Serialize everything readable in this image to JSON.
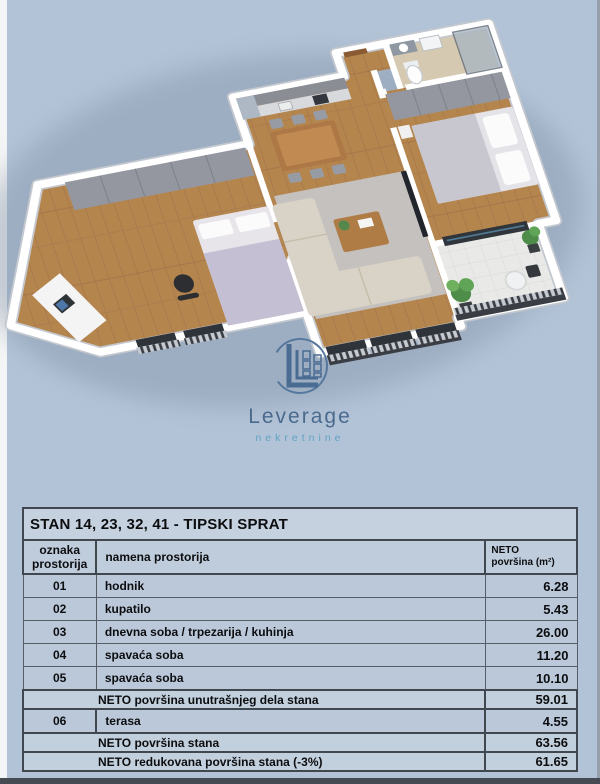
{
  "page": {
    "background": "#b3c3d7"
  },
  "branding": {
    "logo_text": "Leverage",
    "logo_subtext": "nekretnine",
    "logo_color": "#4a6a8e",
    "logo_subtext_color": "#5fa3c4",
    "mark_color": "#4a6c92"
  },
  "floorplan_colors": {
    "walls": "#ffffff",
    "wood_floor": "#b5854e",
    "bathroom_floor": "#d6c9b2",
    "terrace_floor": "#e9eae7",
    "rug": "#c6c9ce",
    "sofa": "#d9d2c6",
    "wardrobe": "#94979f",
    "plants": "#55884d",
    "railing": "#3a3e44",
    "shadow": "#7e8ea3"
  },
  "table": {
    "title": "STAN  14, 23, 32, 41 - TIPSKI SPRAT",
    "col_headers": {
      "col1_line1": "oznaka",
      "col1_line2": "prostorija",
      "col2": "namena prostorija",
      "col3_line1": "NETO",
      "col3_line2": "površina (m²)"
    },
    "rows": [
      {
        "code": "01",
        "name": "hodnik",
        "area": "6.28"
      },
      {
        "code": "02",
        "name": "kupatilo",
        "area": "5.43"
      },
      {
        "code": "03",
        "name": "dnevna soba / trpezarija / kuhinja",
        "area": "26.00"
      },
      {
        "code": "04",
        "name": "spavaća soba",
        "area": "11.20"
      },
      {
        "code": "05",
        "name": "spavaća soba",
        "area": "10.10"
      }
    ],
    "summary_inner": {
      "label": "NETO površina unutrašnjeg dela stana",
      "area": "59.01"
    },
    "terrace_row": {
      "code": "06",
      "name": "terasa",
      "area": "4.55"
    },
    "summary_total": {
      "label": "NETO površina stana",
      "area": "63.56"
    },
    "summary_reduced": {
      "label": "NETO redukovana površina stana (-3%)",
      "area": "61.65"
    }
  }
}
